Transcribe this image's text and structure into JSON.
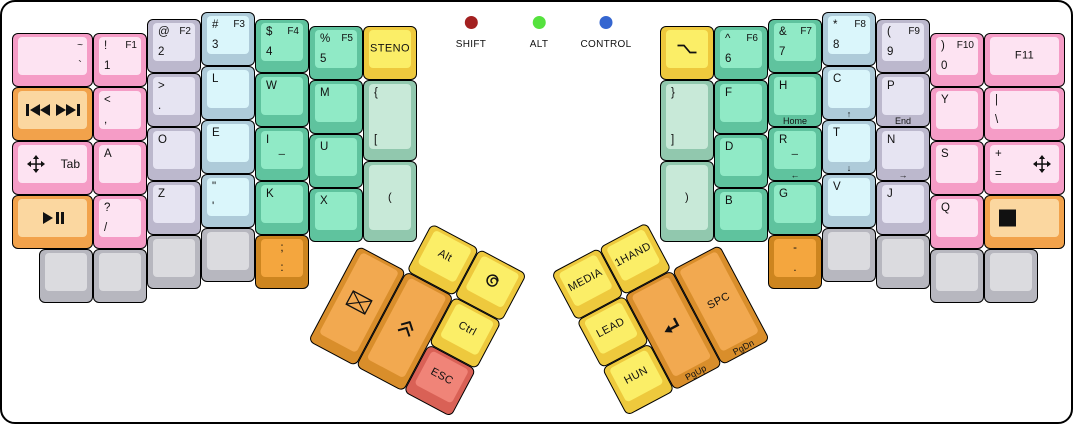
{
  "board": {
    "width": 1073,
    "height": 424,
    "bg": "#ffffff",
    "border_color": "#000000"
  },
  "palette": {
    "pink": [
      "#f59cc6",
      "#fde3f2"
    ],
    "peach": [
      "#f2a24b",
      "#fbd7a0"
    ],
    "lavender": [
      "#bcb8cd",
      "#e6e4f2"
    ],
    "blue": [
      "#aecbd9",
      "#daf6fb"
    ],
    "green": [
      "#5fc39e",
      "#90eac6"
    ],
    "palegreen": [
      "#91c8ae",
      "#c8e9d8"
    ],
    "yellow": [
      "#eec93d",
      "#fbee67"
    ],
    "orange": [
      "#d98e2b",
      "#f2a950"
    ],
    "dorange": [
      "#cd851f",
      "#f4a63e"
    ],
    "salmon": [
      "#d96156",
      "#f08478"
    ],
    "gray": [
      "#b7b7bf",
      "#dbdbdf"
    ]
  },
  "legend": {
    "dot_y": 14,
    "items": [
      {
        "label": "SHIFT",
        "color": "#a32020",
        "x": 469
      },
      {
        "label": "ALT",
        "color": "#55e23e",
        "x": 537
      },
      {
        "label": "CONTROL",
        "color": "#3566d0",
        "x": 604
      }
    ]
  },
  "thumb_groups": [
    {
      "id": "tl",
      "x": 382,
      "y": 196,
      "angle": 28
    },
    {
      "id": "tr",
      "x": 549,
      "y": 271,
      "angle": -28
    }
  ],
  "keys": [
    {
      "n": "tilde-grave",
      "x": 10,
      "y": 31,
      "w": 81,
      "c": "pink",
      "lg": {
        "tr": "~",
        "br": "`"
      }
    },
    {
      "n": "media-prev-next",
      "x": 10,
      "y": 85,
      "w": 81,
      "c": "peach",
      "ic": {
        "c": "media-prev-next"
      }
    },
    {
      "n": "tab-move",
      "x": 10,
      "y": 139,
      "w": 81,
      "c": "pink",
      "lg": {
        "rc": "Tab"
      },
      "ic": {
        "l": "move"
      }
    },
    {
      "n": "play-pause",
      "x": 10,
      "y": 193,
      "w": 81,
      "c": "peach",
      "ic": {
        "c": "play-pause"
      }
    },
    {
      "n": "1-f1",
      "x": 91,
      "y": 31,
      "c": "pink",
      "lg": {
        "tl": "!",
        "tr": "F1",
        "bl": "1"
      }
    },
    {
      "n": "comma",
      "x": 91,
      "y": 85,
      "c": "pink",
      "lg": {
        "tl": "<",
        "bl": ","
      }
    },
    {
      "n": "a",
      "x": 91,
      "y": 139,
      "c": "pink",
      "lg": {
        "tl": "A"
      }
    },
    {
      "n": "question-slash",
      "x": 91,
      "y": 193,
      "c": "pink",
      "lg": {
        "tl": "?",
        "bl": "/"
      }
    },
    {
      "n": "2-f2",
      "x": 145,
      "y": 17,
      "c": "lavender",
      "lg": {
        "tl": "@",
        "tr": "F2",
        "bl": "2"
      }
    },
    {
      "n": "period",
      "x": 145,
      "y": 71,
      "c": "lavender",
      "lg": {
        "tl": ">",
        "bl": "."
      }
    },
    {
      "n": "o",
      "x": 145,
      "y": 125,
      "c": "lavender",
      "lg": {
        "tl": "O"
      }
    },
    {
      "n": "z",
      "x": 145,
      "y": 179,
      "c": "lavender",
      "lg": {
        "tl": "Z"
      }
    },
    {
      "n": "3-f3",
      "x": 199,
      "y": 10,
      "c": "blue",
      "lg": {
        "tl": "#",
        "tr": "F3",
        "bl": "3"
      }
    },
    {
      "n": "l",
      "x": 199,
      "y": 64,
      "c": "blue",
      "lg": {
        "tl": "L"
      }
    },
    {
      "n": "e",
      "x": 199,
      "y": 118,
      "c": "blue",
      "lg": {
        "tl": "E"
      }
    },
    {
      "n": "quote",
      "x": 199,
      "y": 172,
      "c": "blue",
      "lg": {
        "tl": "\"",
        "bl": "'"
      }
    },
    {
      "n": "4-f4",
      "x": 253,
      "y": 17,
      "c": "green",
      "lg": {
        "tl": "$",
        "tr": "F4",
        "bl": "4"
      }
    },
    {
      "n": "w",
      "x": 253,
      "y": 71,
      "c": "green",
      "lg": {
        "tl": "W"
      }
    },
    {
      "n": "i-underscore",
      "x": 253,
      "y": 125,
      "c": "green",
      "lg": {
        "tl": "I",
        "cc": "_"
      }
    },
    {
      "n": "k",
      "x": 253,
      "y": 179,
      "c": "green",
      "lg": {
        "tl": "K"
      }
    },
    {
      "n": "5-f5",
      "x": 307,
      "y": 24,
      "c": "green",
      "lg": {
        "tl": "%",
        "tr": "F5",
        "bl": "5"
      }
    },
    {
      "n": "m",
      "x": 307,
      "y": 78,
      "c": "green",
      "lg": {
        "tl": "M"
      }
    },
    {
      "n": "u",
      "x": 307,
      "y": 132,
      "c": "green",
      "lg": {
        "tl": "U"
      }
    },
    {
      "n": "x",
      "x": 307,
      "y": 186,
      "c": "green",
      "lg": {
        "tl": "X"
      }
    },
    {
      "n": "steno",
      "x": 361,
      "y": 24,
      "c": "yellow",
      "lg": {
        "cc": "STENO"
      }
    },
    {
      "n": "lbrace-lbracket",
      "x": 361,
      "y": 78,
      "h": 81,
      "c": "palegreen",
      "lg": {
        "tl": "{",
        "bl": "["
      }
    },
    {
      "n": "lparen",
      "x": 361,
      "y": 159,
      "h": 81,
      "c": "palegreen",
      "lg": {
        "cc": "("
      }
    },
    {
      "n": "blank-l1",
      "x": 37,
      "y": 247,
      "c": "gray"
    },
    {
      "n": "blank-l2",
      "x": 91,
      "y": 247,
      "c": "gray"
    },
    {
      "n": "blank-l3",
      "x": 145,
      "y": 233,
      "c": "gray"
    },
    {
      "n": "blank-l4",
      "x": 199,
      "y": 226,
      "c": "gray"
    },
    {
      "n": "semicolon-colon",
      "x": 253,
      "y": 233,
      "c": "dorange",
      "lg": {
        "tc": ";",
        "bc": ":"
      }
    },
    {
      "n": "option",
      "x": 658,
      "y": 24,
      "c": "yellow",
      "ic": {
        "c": "option"
      }
    },
    {
      "n": "rbrace-rbracket",
      "x": 658,
      "y": 78,
      "h": 81,
      "c": "palegreen",
      "lg": {
        "tl": "}",
        "bl": "]"
      }
    },
    {
      "n": "rparen",
      "x": 658,
      "y": 159,
      "h": 81,
      "c": "palegreen",
      "lg": {
        "cc": ")"
      }
    },
    {
      "n": "6-f6",
      "x": 712,
      "y": 24,
      "c": "green",
      "lg": {
        "tl": "^",
        "tr": "F6",
        "bl": "6"
      }
    },
    {
      "n": "f",
      "x": 712,
      "y": 78,
      "c": "green",
      "lg": {
        "tl": "F"
      }
    },
    {
      "n": "d",
      "x": 712,
      "y": 132,
      "c": "green",
      "lg": {
        "tl": "D"
      }
    },
    {
      "n": "b",
      "x": 712,
      "y": 186,
      "c": "green",
      "lg": {
        "tl": "B"
      }
    },
    {
      "n": "7-f7",
      "x": 766,
      "y": 17,
      "c": "green",
      "lg": {
        "tl": "&",
        "tr": "F7",
        "bl": "7"
      }
    },
    {
      "n": "h-home",
      "x": 766,
      "y": 71,
      "c": "green",
      "lg": {
        "tl": "H",
        "fr": "Home"
      }
    },
    {
      "n": "r-left",
      "x": 766,
      "y": 125,
      "c": "green",
      "lg": {
        "tl": "R",
        "cc": "_",
        "fr": "←"
      }
    },
    {
      "n": "g",
      "x": 766,
      "y": 179,
      "c": "green",
      "lg": {
        "tl": "G"
      }
    },
    {
      "n": "8-f8",
      "x": 820,
      "y": 10,
      "c": "blue",
      "lg": {
        "tl": "*",
        "tr": "F8",
        "bl": "8"
      }
    },
    {
      "n": "c-up",
      "x": 820,
      "y": 64,
      "c": "blue",
      "lg": {
        "tl": "C",
        "fr": "↑"
      }
    },
    {
      "n": "t-down",
      "x": 820,
      "y": 118,
      "c": "blue",
      "lg": {
        "tl": "T",
        "fr": "↓"
      }
    },
    {
      "n": "v",
      "x": 820,
      "y": 172,
      "c": "blue",
      "lg": {
        "tl": "V"
      }
    },
    {
      "n": "9-f9",
      "x": 874,
      "y": 17,
      "c": "lavender",
      "lg": {
        "tl": "(",
        "tr": "F9",
        "bl": "9"
      }
    },
    {
      "n": "p-end",
      "x": 874,
      "y": 71,
      "c": "lavender",
      "lg": {
        "tl": "P",
        "fr": "End"
      }
    },
    {
      "n": "n-right",
      "x": 874,
      "y": 125,
      "c": "lavender",
      "lg": {
        "tl": "N",
        "fr": "→"
      }
    },
    {
      "n": "j",
      "x": 874,
      "y": 179,
      "c": "lavender",
      "lg": {
        "tl": "J"
      }
    },
    {
      "n": "0-f10",
      "x": 928,
      "y": 31,
      "c": "pink",
      "lg": {
        "tl": ")",
        "tr": "F10",
        "bl": "0"
      }
    },
    {
      "n": "y",
      "x": 928,
      "y": 85,
      "c": "pink",
      "lg": {
        "tl": "Y"
      }
    },
    {
      "n": "s",
      "x": 928,
      "y": 139,
      "c": "pink",
      "lg": {
        "tl": "S"
      }
    },
    {
      "n": "q",
      "x": 928,
      "y": 193,
      "c": "pink",
      "lg": {
        "tl": "Q"
      }
    },
    {
      "n": "f11",
      "x": 982,
      "y": 31,
      "w": 81,
      "c": "pink",
      "lg": {
        "cc": "F11"
      }
    },
    {
      "n": "pipe-backslash",
      "x": 982,
      "y": 85,
      "w": 81,
      "c": "pink",
      "lg": {
        "tl": "|",
        "bl": "\\"
      }
    },
    {
      "n": "plus-equals-move",
      "x": 982,
      "y": 139,
      "w": 81,
      "c": "pink",
      "lg": {
        "tl": "+",
        "bl": "="
      },
      "ic": {
        "r": "move"
      }
    },
    {
      "n": "stop",
      "x": 982,
      "y": 193,
      "w": 81,
      "c": "peach",
      "ic": {
        "l": "stop"
      }
    },
    {
      "n": "dash-period",
      "x": 766,
      "y": 233,
      "c": "dorange",
      "lg": {
        "tc": "-",
        "bc": "."
      }
    },
    {
      "n": "blank-r1",
      "x": 820,
      "y": 226,
      "c": "gray"
    },
    {
      "n": "blank-r2",
      "x": 874,
      "y": 233,
      "c": "gray"
    },
    {
      "n": "blank-r3",
      "x": 928,
      "y": 247,
      "c": "gray"
    },
    {
      "n": "blank-r4",
      "x": 982,
      "y": 247,
      "c": "gray"
    },
    {
      "n": "alt",
      "g": "tl",
      "x": 54,
      "y": 0,
      "c": "yellow",
      "lg": {
        "cc": "Alt"
      }
    },
    {
      "n": "super-swirl",
      "g": "tl",
      "x": 108,
      "y": 0,
      "c": "yellow",
      "ic": {
        "c": "swirl"
      }
    },
    {
      "n": "mail",
      "g": "tl",
      "x": 0,
      "y": 54,
      "h": 108,
      "c": "orange",
      "ic": {
        "c": "envelope"
      }
    },
    {
      "n": "double-chevron-up",
      "g": "tl",
      "x": 54,
      "y": 54,
      "h": 108,
      "c": "orange",
      "ic": {
        "c": "chevron-up"
      }
    },
    {
      "n": "ctrl",
      "g": "tl",
      "x": 108,
      "y": 54,
      "c": "yellow",
      "lg": {
        "cc": "Ctrl"
      }
    },
    {
      "n": "esc",
      "g": "tl",
      "x": 108,
      "y": 108,
      "c": "salmon",
      "lg": {
        "cc": "ESC"
      }
    },
    {
      "n": "media",
      "g": "tr",
      "x": 0,
      "y": 0,
      "c": "yellow",
      "lg": {
        "cc": "MEDIA"
      }
    },
    {
      "n": "1hand",
      "g": "tr",
      "x": 54,
      "y": 0,
      "c": "yellow",
      "lg": {
        "cc": "1HAND"
      }
    },
    {
      "n": "lead",
      "g": "tr",
      "x": 0,
      "y": 54,
      "c": "yellow",
      "lg": {
        "cc": "LEAD"
      }
    },
    {
      "n": "enter-pgup",
      "g": "tr",
      "x": 54,
      "y": 54,
      "h": 108,
      "c": "orange",
      "lg": {
        "fr": "PgUp"
      },
      "ic": {
        "c": "return-arrow"
      }
    },
    {
      "n": "spc-pgdn",
      "g": "tr",
      "x": 108,
      "y": 54,
      "h": 108,
      "c": "orange",
      "lg": {
        "cc": "SPC",
        "fr": "PgDn"
      }
    },
    {
      "n": "hun",
      "g": "tr",
      "x": 0,
      "y": 108,
      "c": "yellow",
      "lg": {
        "cc": "HUN"
      }
    }
  ]
}
